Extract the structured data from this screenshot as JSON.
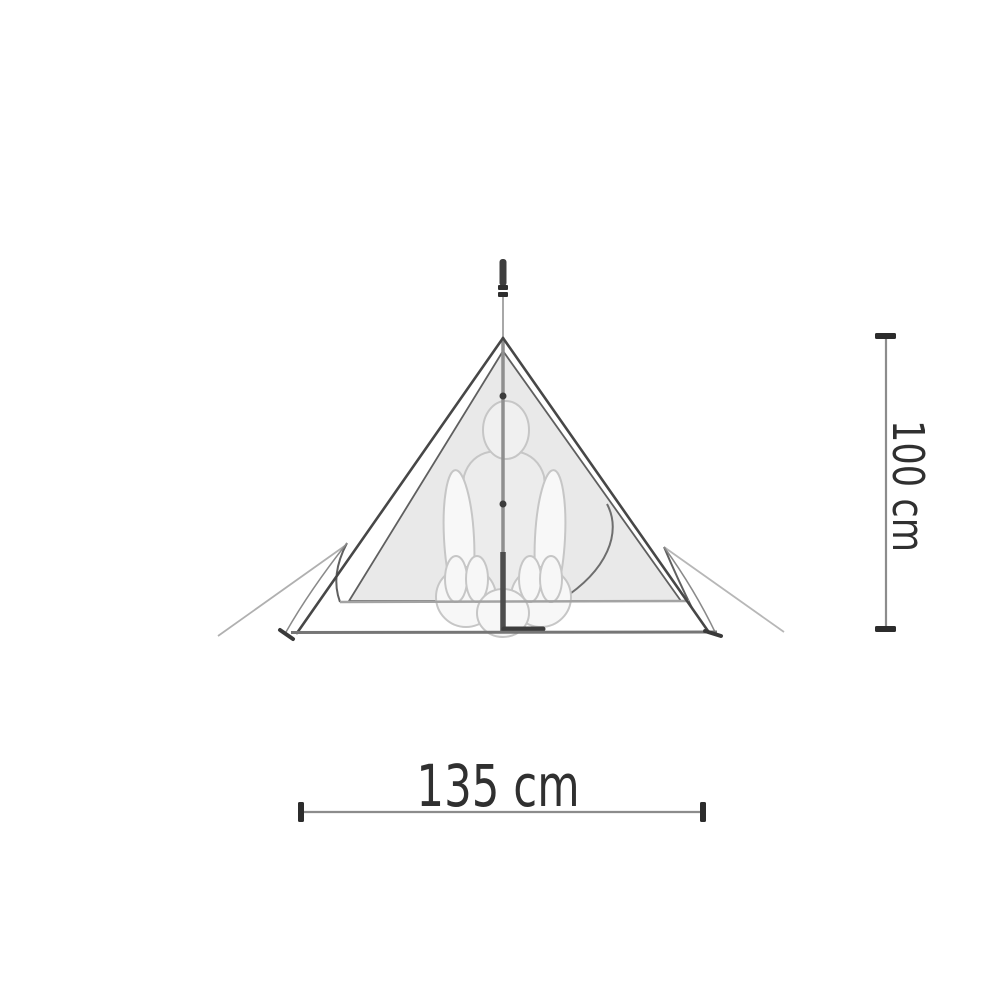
{
  "page": {
    "type": "product-dimension-diagram",
    "background": "#ffffff"
  },
  "diagram": {
    "subject": "single-pole pyramid tent side profile with seated person silhouette",
    "elements": {
      "tarp": "triangular outer tarp",
      "inner_tent": "gray inner tent panel with curved door edge",
      "pole": "center pole extending above the apex",
      "figure": "person seated cross-legged inside",
      "guy_lines": "guy lines staked out beyond both base corners",
      "ground": "ground line with corner stakes"
    },
    "colors": {
      "tarp_outline": "#474747",
      "inner_edge": "#5f5f5f",
      "inner_fill": "#e9e9e9",
      "figure_outline": "#c6c6c6",
      "floor_line": "#a3a3a3",
      "ground_line": "#767676",
      "guy_line": "#b0b0b0",
      "pole_dark": "#3d3d3d",
      "dimension_line": "#8c8c8c",
      "dimension_cap": "#2c2c2c",
      "label_text": "#303030"
    },
    "dimensions": {
      "width": {
        "value": 135,
        "unit": "cm",
        "label": "135 cm"
      },
      "height": {
        "value": 100,
        "unit": "cm",
        "label": "100 cm"
      }
    }
  }
}
